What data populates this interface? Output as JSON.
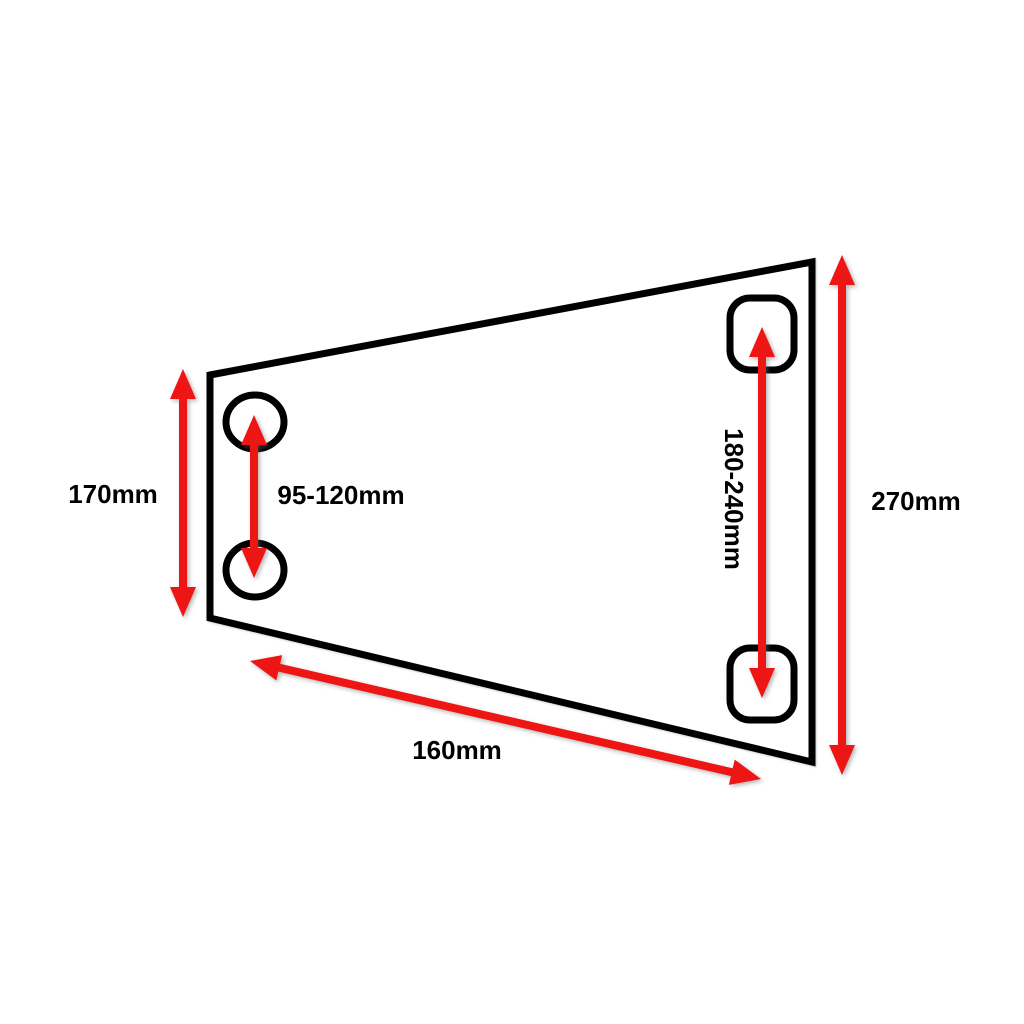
{
  "diagram": {
    "kind": "dimension-diagram",
    "subject": "trapezoidal plate with four mounting holes",
    "labels": {
      "left_height": "170mm",
      "left_hole_spacing": "95-120mm",
      "right_hole_spacing": "180-240mm",
      "right_height": "270mm",
      "bottom_width": "160mm"
    },
    "dimensions": [
      {
        "id": "left-height",
        "label": "170mm"
      },
      {
        "id": "left-hole-spacing",
        "label": "95-120mm"
      },
      {
        "id": "right-hole-spacing",
        "label": "180-240mm"
      },
      {
        "id": "right-height",
        "label": "270mm"
      },
      {
        "id": "bottom-width",
        "label": "160mm"
      }
    ]
  },
  "colors": {
    "dimension_arrow": "#ee1515",
    "plate_outline": "#000000",
    "background": "#ffffff"
  }
}
